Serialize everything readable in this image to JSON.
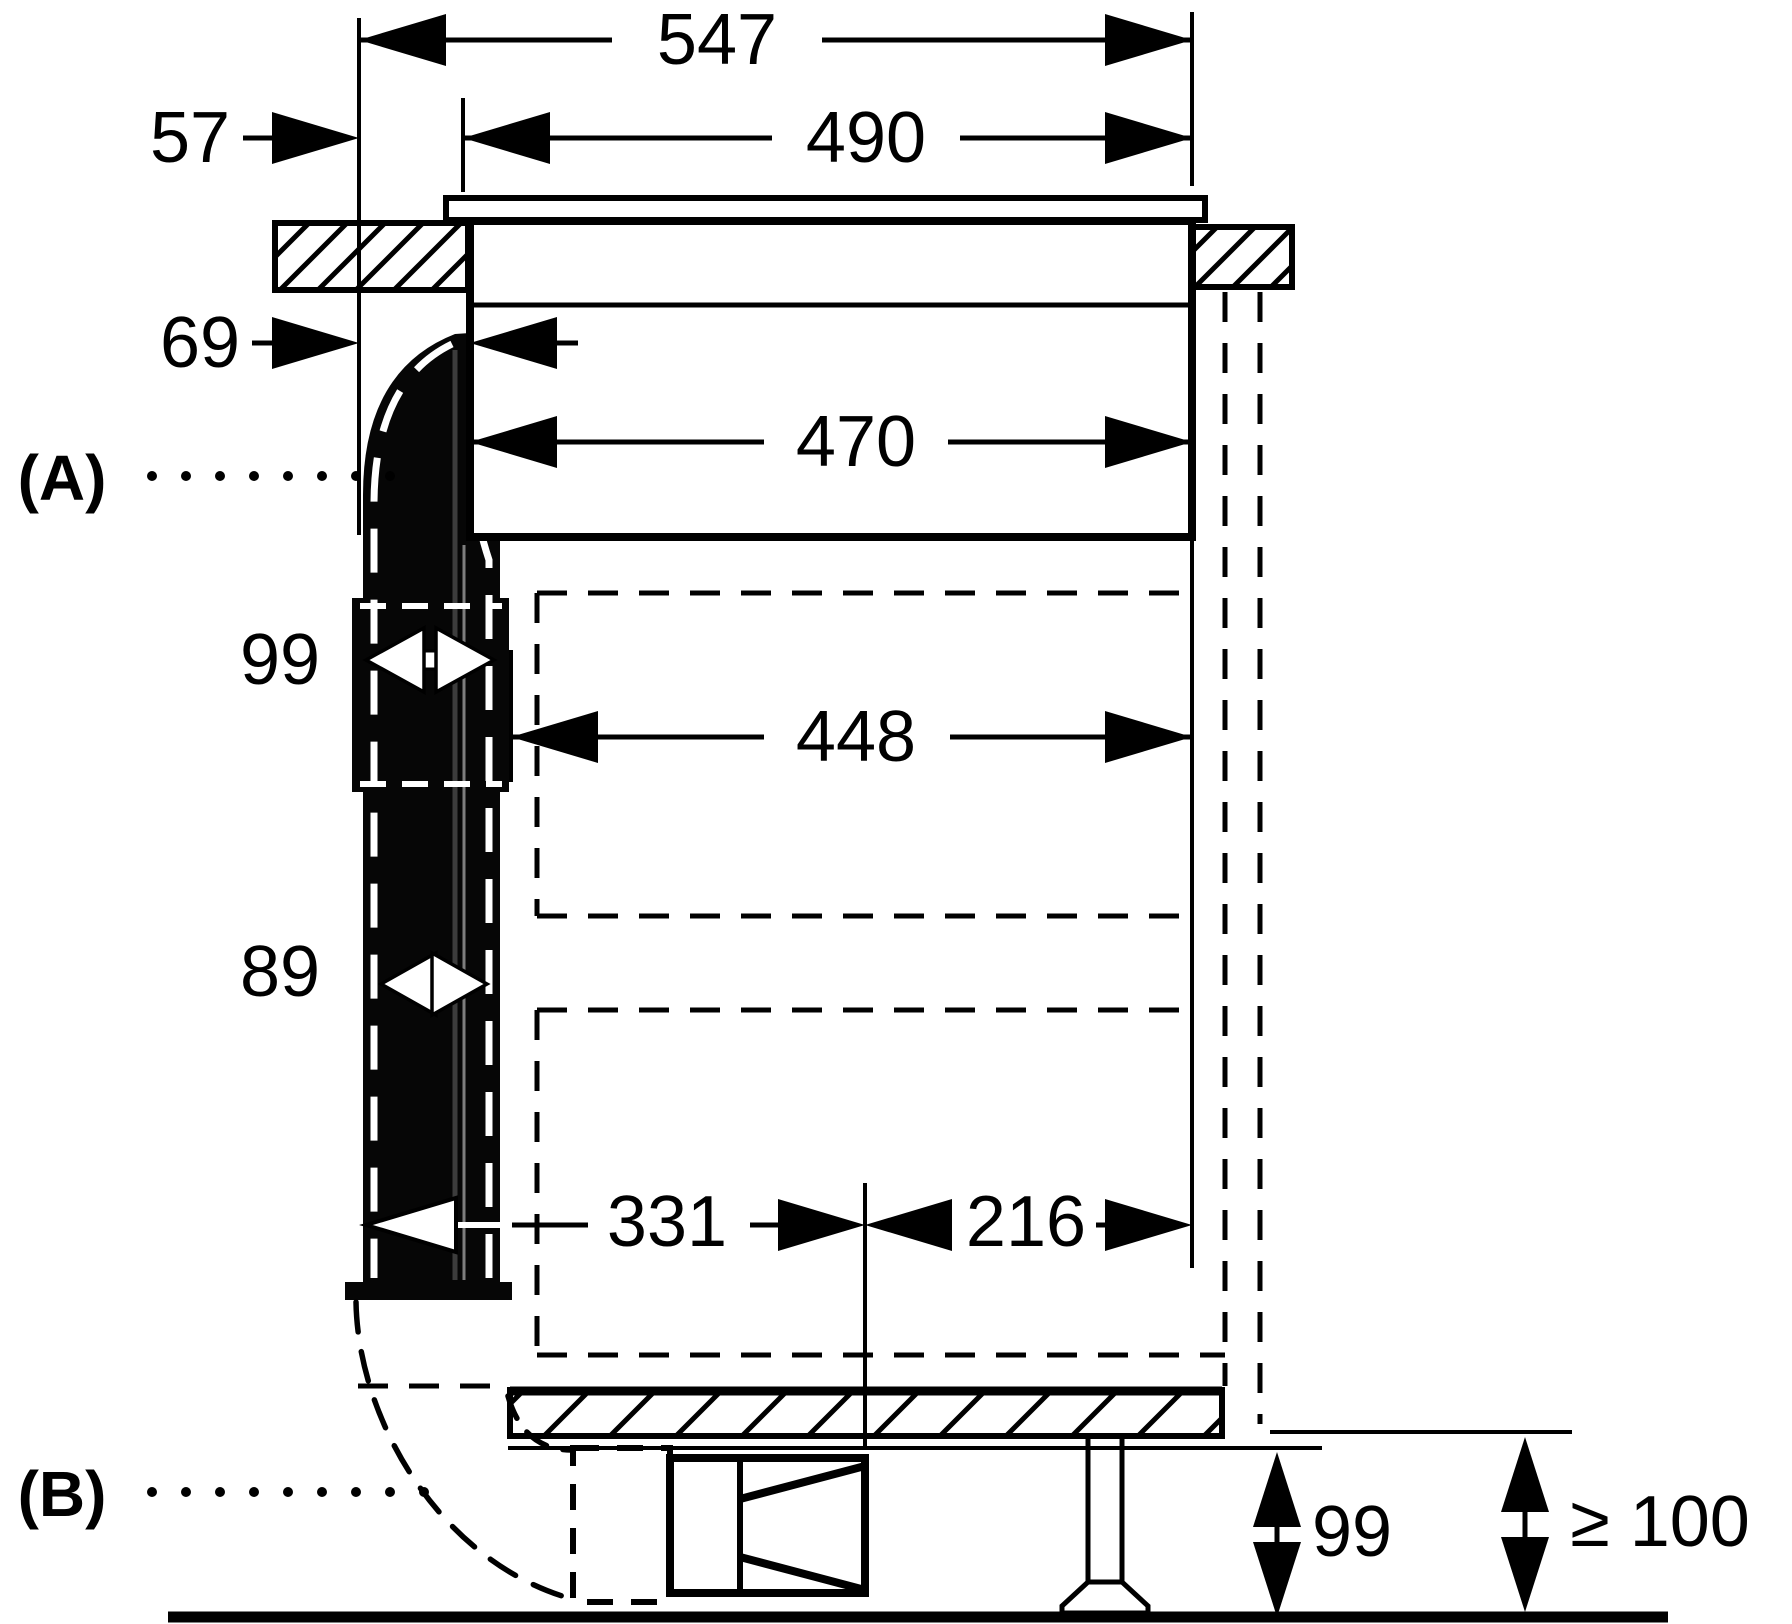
{
  "diagram": {
    "kind": "appliance-installation-side-view",
    "units_implied": "mm",
    "labels": {
      "a": "(A)",
      "b": "(B)"
    },
    "dims": {
      "total_depth": "547",
      "cutout_width": "490",
      "back_to_glass": "57",
      "back_to_cutout": "69",
      "body_width": "470",
      "duct_coupler_width": "99",
      "cabinet_clearance": "448",
      "duct_width": "89",
      "duct_to_center": "331",
      "center_to_wall": "216",
      "plinth_height": "99",
      "floor_clearance": "≥ 100"
    }
  }
}
